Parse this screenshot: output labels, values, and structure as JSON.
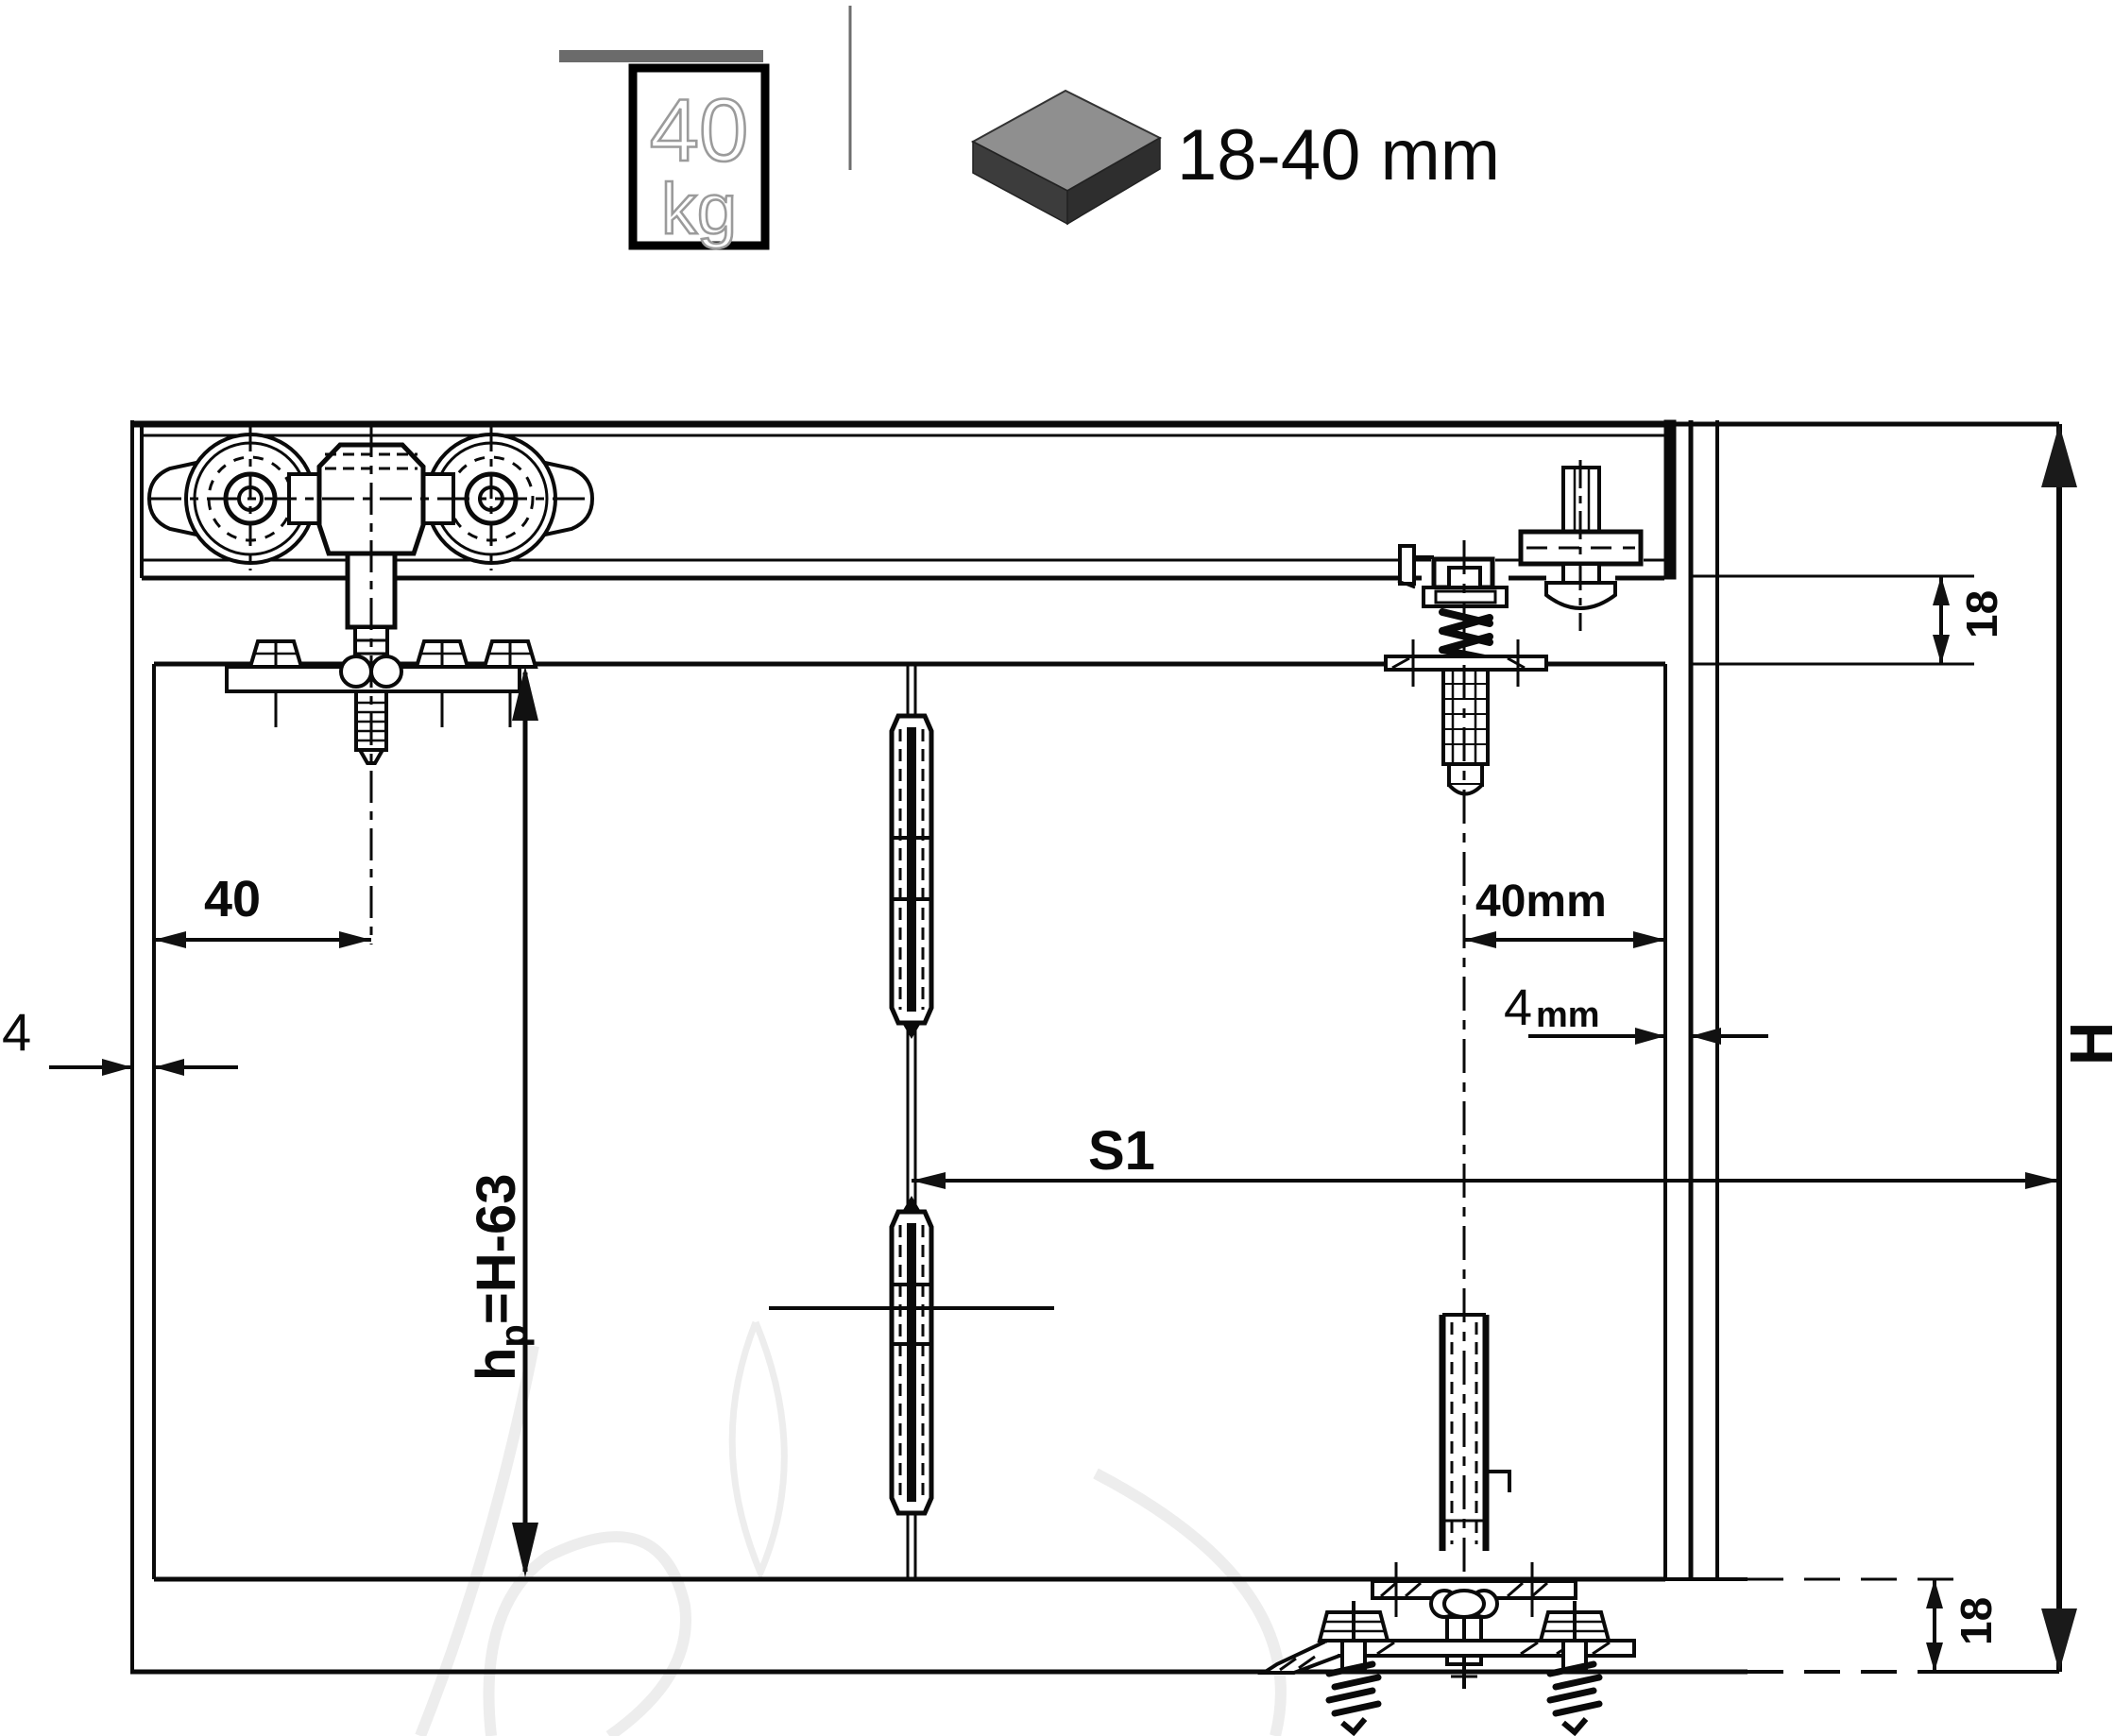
{
  "icons": {
    "weight_capacity": {
      "value": "40",
      "unit": "kg"
    },
    "panel_thickness": {
      "label": "18-40 mm"
    }
  },
  "dimensions": {
    "front_pivot_offset": "40",
    "left_gap": "4",
    "top_clearance": "18",
    "door_height": {
      "base": "h",
      "sub": "p",
      "rest": "=H-63"
    },
    "opening_span": "S1",
    "rear_pivot_offset": "40mm",
    "right_gap": {
      "value": "4",
      "unit": "mm"
    },
    "total_height": "H",
    "bottom_clearance": "18"
  },
  "colors": {
    "line": "#0a0a0a",
    "track_bar": "#6b6b6b",
    "slab_top": "#8f8f8f",
    "slab_side_dark": "#2e2e2e",
    "slab_side": "#3c3c3c",
    "watermark": "#ededed"
  }
}
